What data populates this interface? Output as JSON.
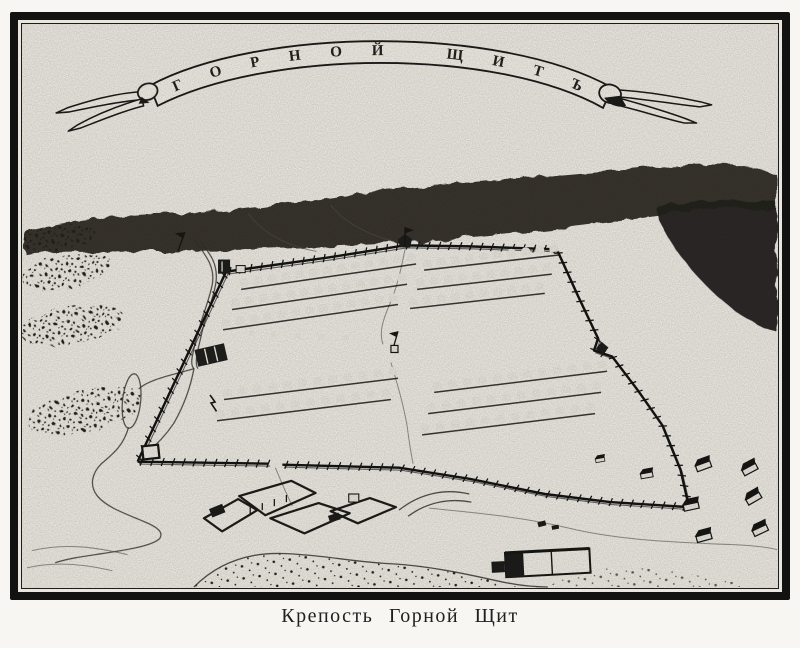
{
  "figure": {
    "banner_text": "ГОРНОЙ ЩИТЪ",
    "caption": "Крепость Горной Щит"
  },
  "colors": {
    "paper": "#e9e6df",
    "ink": "#1a1a18",
    "hill": "#272521",
    "page_background": "#f7f6f2"
  },
  "fortress": {
    "walls": [
      {
        "name": "north",
        "pts": [
          [
            228,
            272
          ],
          [
            330,
            258
          ],
          [
            406,
            246
          ],
          [
            470,
            247
          ],
          [
            557,
            250
          ]
        ]
      },
      {
        "name": "west",
        "pts": [
          [
            228,
            272
          ],
          [
            140,
            460
          ]
        ]
      },
      {
        "name": "east",
        "pts": [
          [
            557,
            250
          ],
          [
            578,
            296
          ],
          [
            598,
            338
          ],
          [
            594,
            350
          ],
          [
            612,
            356
          ],
          [
            638,
            390
          ],
          [
            662,
            424
          ],
          [
            680,
            468
          ],
          [
            688,
            503
          ]
        ]
      },
      {
        "name": "south-west",
        "pts": [
          [
            140,
            460
          ],
          [
            270,
            462
          ]
        ]
      },
      {
        "name": "south-east",
        "pts": [
          [
            284,
            463
          ],
          [
            400,
            466
          ],
          [
            470,
            477
          ],
          [
            545,
            492
          ],
          [
            610,
            500
          ],
          [
            688,
            505
          ]
        ]
      }
    ],
    "blocks": [
      {
        "name": "north-west",
        "x1": 242,
        "y1": 287,
        "x2": 408,
        "y2": 262,
        "rows": 3,
        "cols": 13,
        "rdx": -9,
        "rdy": 20
      },
      {
        "name": "north-east",
        "x1": 424,
        "y1": 268,
        "x2": 550,
        "y2": 253,
        "rows": 3,
        "cols": 10,
        "rdx": -7,
        "rdy": 19
      },
      {
        "name": "south-west",
        "x1": 225,
        "y1": 396,
        "x2": 390,
        "y2": 375,
        "rows": 2,
        "cols": 12,
        "rdx": -7,
        "rdy": 21
      },
      {
        "name": "south-east",
        "x1": 434,
        "y1": 389,
        "x2": 598,
        "y2": 368,
        "rows": 3,
        "cols": 12,
        "rdx": -6,
        "rdy": 21
      }
    ],
    "minor_houses": [
      [
        250,
        335
      ],
      [
        272,
        337
      ],
      [
        296,
        338
      ],
      [
        320,
        339
      ],
      [
        344,
        340
      ]
    ],
    "huts": [
      {
        "x": 697,
        "y": 470,
        "r": -20
      },
      {
        "x": 744,
        "y": 474,
        "r": -28
      },
      {
        "x": 684,
        "y": 509,
        "r": -12
      },
      {
        "x": 748,
        "y": 503,
        "r": -30
      },
      {
        "x": 697,
        "y": 540,
        "r": -15
      },
      {
        "x": 754,
        "y": 534,
        "r": -25
      },
      {
        "x": 641,
        "y": 477,
        "r": -10,
        "s": 0.8
      },
      {
        "x": 596,
        "y": 461,
        "r": -10,
        "s": 0.6
      }
    ]
  }
}
